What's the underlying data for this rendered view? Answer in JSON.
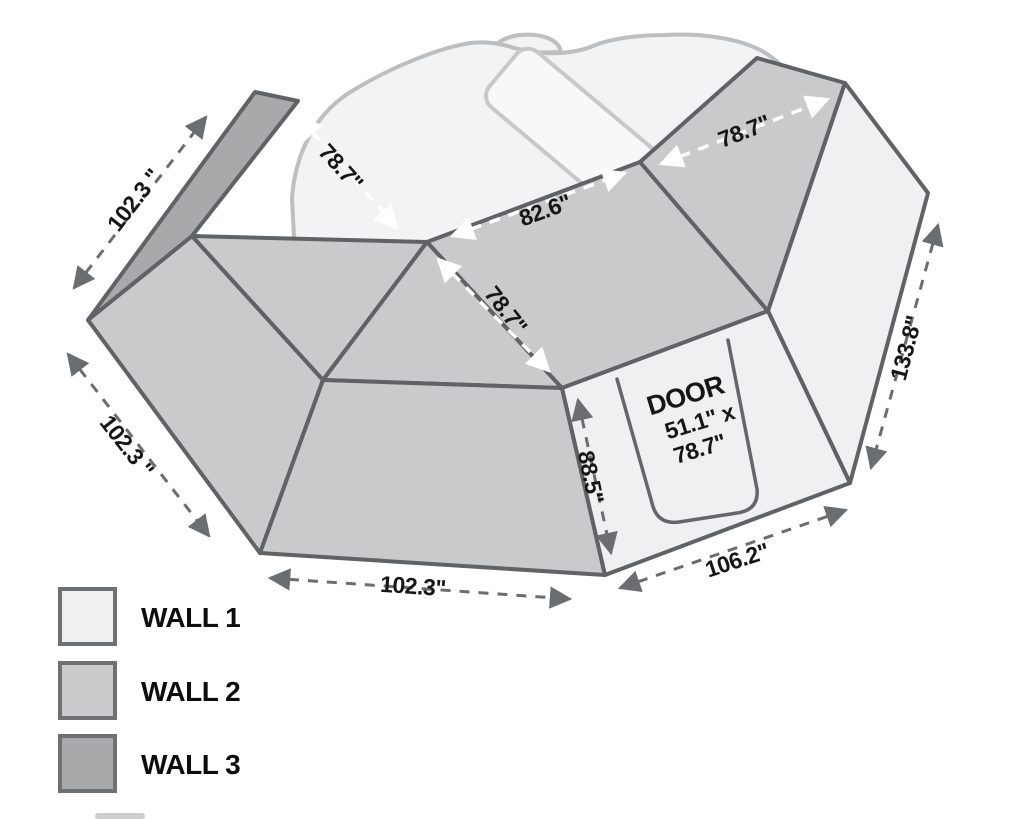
{
  "diagram": {
    "title": "awning-walls-dimension-diagram",
    "labels": {
      "dim_top_left_edge": "102.3 \"",
      "dim_left_edge": "102.3 \"",
      "dim_bottom_edge": "102.3\"",
      "dim_bottom_right_edge": "106.2\"",
      "dim_right_edge": "133.8\"",
      "dim_door_panel_height": "88.5\"",
      "dim_left_wall_width": "78.7\"",
      "dim_back_wall_width": "82.6\"",
      "dim_mid_wall_width": "78.7\"",
      "dim_right_wall_width": "78.7\""
    },
    "door": {
      "title": "DOOR",
      "size_line1": "51.1\" x",
      "size_line2": "78.7\""
    },
    "legend": {
      "items": [
        {
          "label": "WALL 1",
          "color": "#eef0f1"
        },
        {
          "label": "WALL 2",
          "color": "#c9cacc"
        },
        {
          "label": "WALL 3",
          "color": "#a7a9ab"
        }
      ]
    },
    "colors": {
      "outline": "#5f6366",
      "dim_arrow": "#6b6e71",
      "inner_arrow": "#ffffff",
      "background_shape": "#f2f3f4"
    }
  }
}
